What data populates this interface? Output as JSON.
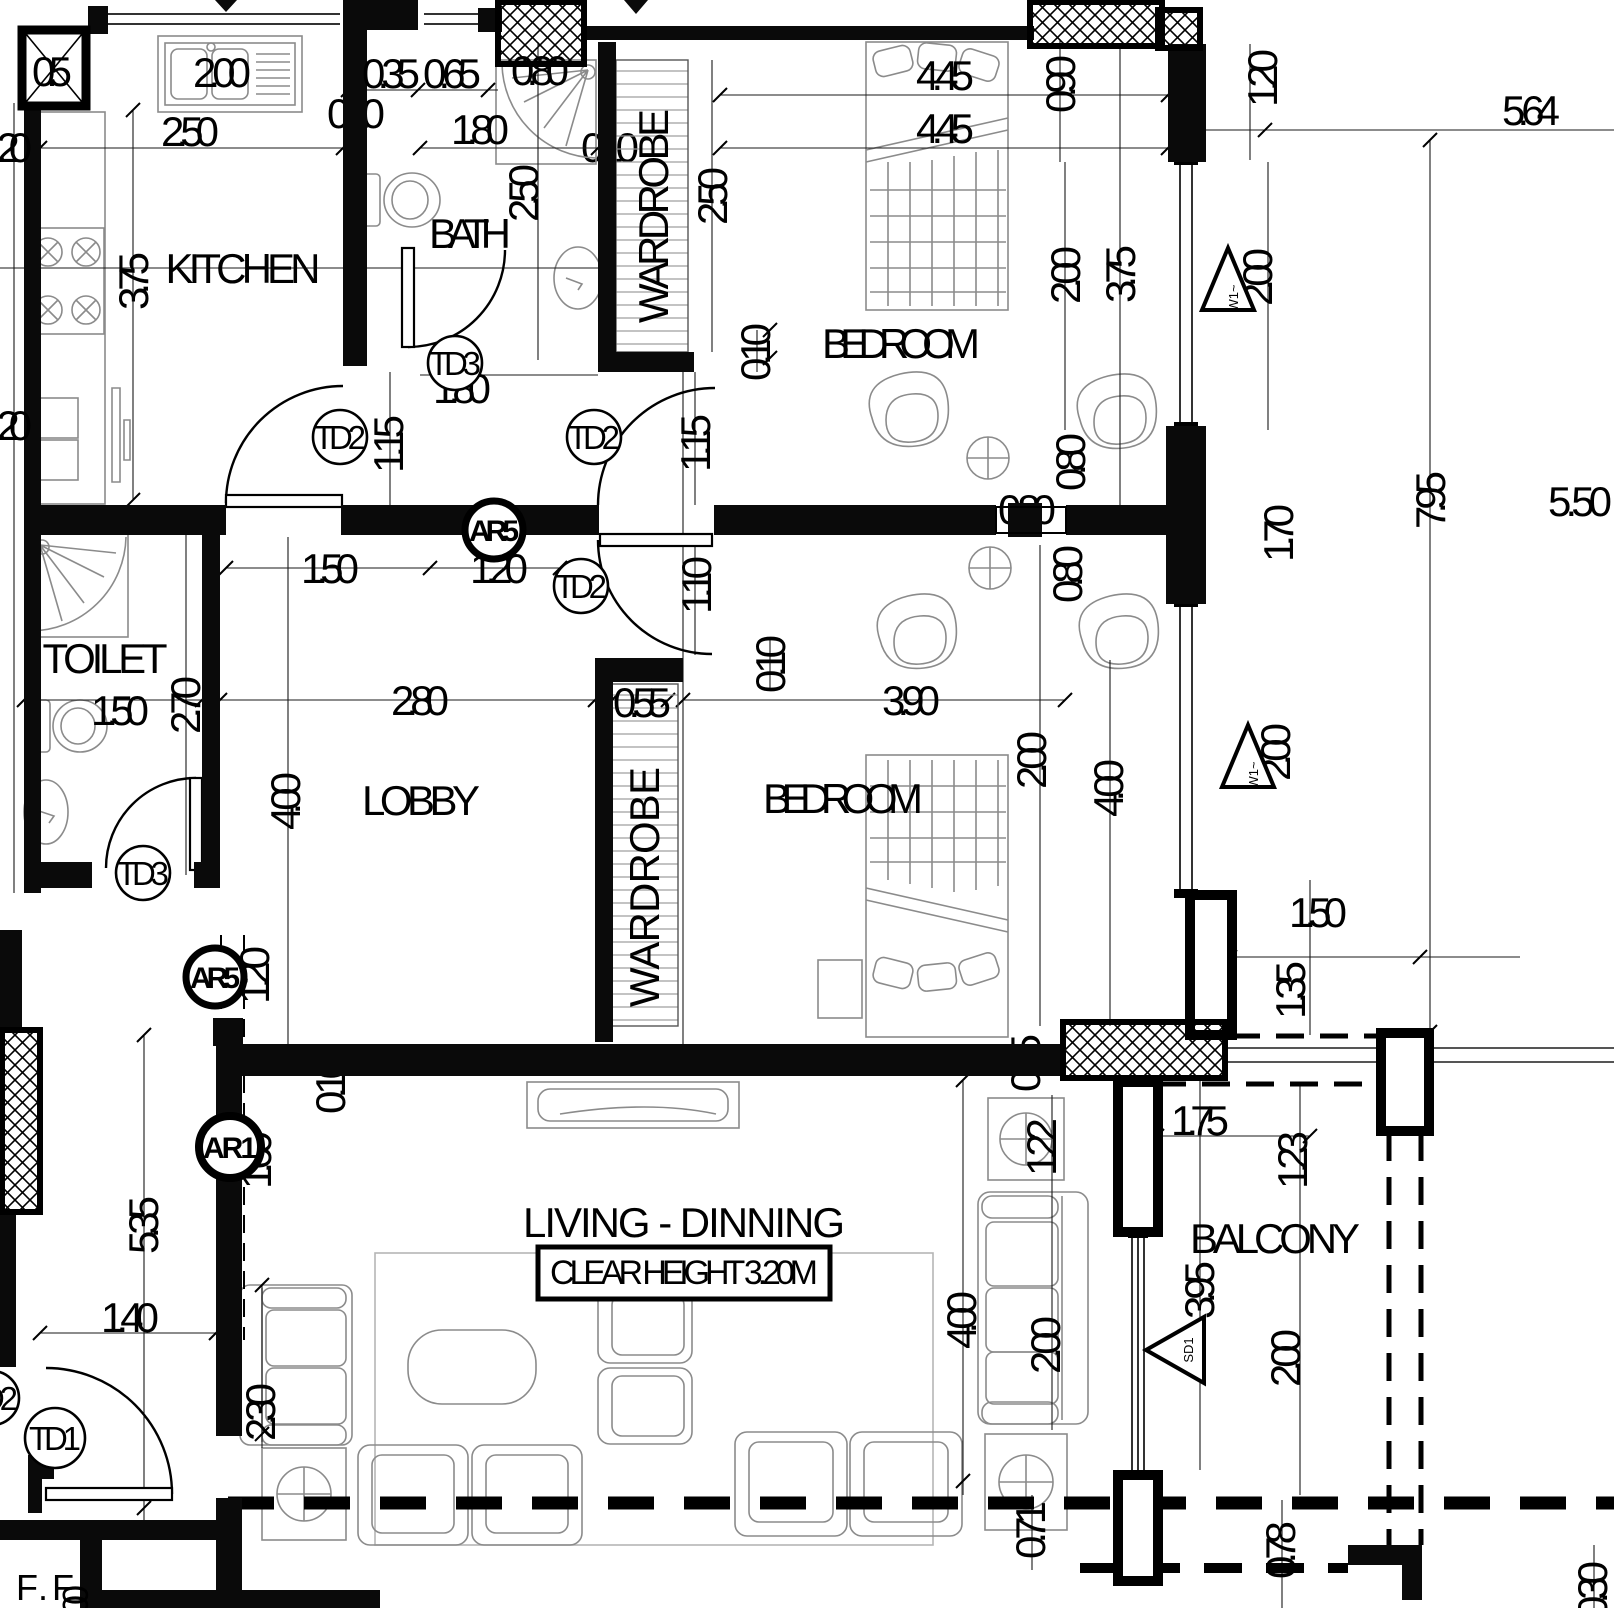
{
  "drawing": {
    "type": "architectural-floor-plan",
    "rooms": {
      "kitchen": "KITCHEN",
      "bath": "BATH",
      "wardrobe_top": "WARDROBE",
      "bedroom_top": "BEDROOM",
      "toilet": "TOILET",
      "lobby": "LOBBY",
      "wardrobe_mid": "WARDROBE",
      "bedroom_mid": "BEDROOM",
      "living": "LIVING - DINNING",
      "clear_height": "CLEAR HEIGHT 3.20M",
      "balcony": "BALCONY",
      "floor_level": "F.F",
      "floor_level_frag": "00"
    },
    "door_tags": {
      "td1": "TD1",
      "td2": "TD2",
      "td3": "TD3"
    },
    "ar_tags": {
      "ar5": "AR5",
      "ar1": "AR1"
    },
    "window_tags": {
      "w1": "W1~",
      "sd1": "SD1"
    },
    "dims": {
      "k_sink": "2.00",
      "k_width": "2.50",
      "k_375": "3.75",
      "b_035": "0.35",
      "b_065": "0.65",
      "b_080": "0.80",
      "b_door": "1.80",
      "bath_250": "2.50",
      "bath_td3": "1.80",
      "w010a": "0.10",
      "w010b": "0.10",
      "wr_010": "0.10",
      "wr1_250": "2.50",
      "bed1_445a": "4.45",
      "bed1_445b": "4.45",
      "bed1_090": "0.90",
      "bed1_200": "2.00",
      "bed1_375": "3.75",
      "w1a_200": "2.00",
      "w1b_200": "2.00",
      "r_564": "5.64",
      "r_120": "1.20",
      "r_170": "1.70",
      "r_795": "7.95",
      "r_550": "5.50",
      "d_115a": "1.15",
      "d_115b": "1.15",
      "d_110": "1.10",
      "lb_150": "1.50",
      "lb_120": "1.20",
      "lb_280": "2.80",
      "lb_400": "4.00",
      "t_150": "1.50",
      "t_270": "2.70",
      "wr_055": "0.55",
      "bed2_010": "0.10",
      "bed2_390": "3.90",
      "bed2_200": "2.00",
      "bed2_400": "4.00",
      "ch_080a": "0.80",
      "ch_080b": "0.80",
      "ch_080c": "0.80",
      "bal_150": "1.50",
      "bal_135": "1.35",
      "bal_123": "1.23",
      "bal_175": "1.75",
      "bal_200": "2.00",
      "lv_122": "1.22",
      "lv_400": "4.00",
      "lv_200": "2.00",
      "lv_230": "2.30",
      "sd_395": "3.95",
      "c_140": "1.40",
      "c_535": "5.35",
      "ar1_160": "1.60",
      "ar5_120": "1.20",
      "b_071": "0.71",
      "b_078": "0.78",
      "b_030": "0.30",
      "wall_015": "0.15",
      "wall_010": "0.10",
      "shaft_05": "0.5",
      "left_20a": ".20",
      "left_20b": ".20"
    }
  }
}
